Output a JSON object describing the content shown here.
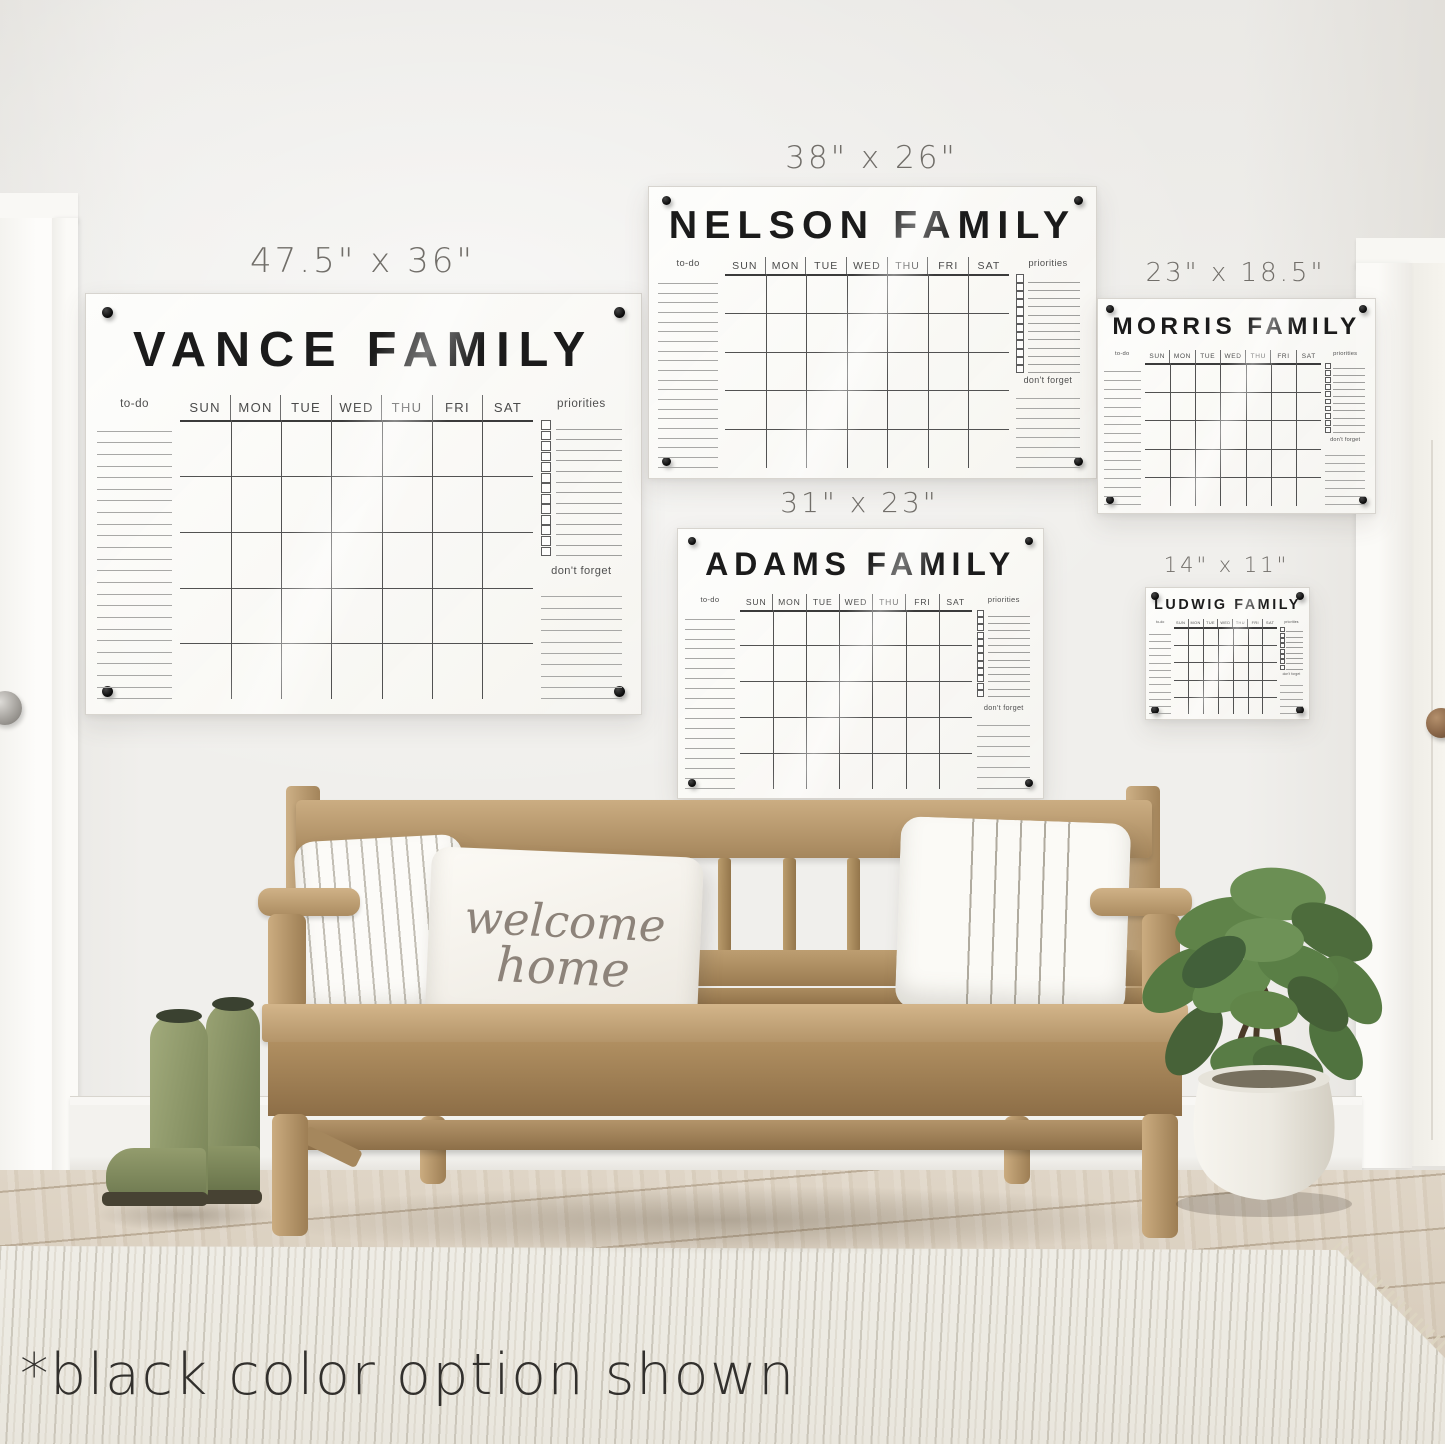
{
  "caption": "*black color option shown",
  "welcome_pillow": {
    "line1": "welcome",
    "line2": "home"
  },
  "shared": {
    "todo_label": "to-do",
    "priorities_label": "priorities",
    "dont_forget_label": "don't forget",
    "day_headers": [
      "SUN",
      "MON",
      "TUE",
      "WED",
      "THU",
      "FRI",
      "SAT"
    ]
  },
  "colors": {
    "marker_black": "#141414",
    "panel_white": "#fbfaf8",
    "wall": "#f0efec",
    "bench_wood": "#b7976c",
    "floor_wood": "#d8cdbd",
    "rug": "#edeae2",
    "boots_green": "#8a9366",
    "plant_green": "#5d7f47",
    "size_label_gray": "#716e69"
  },
  "calendars": [
    {
      "id": "vance",
      "title": "VANCE FAMILY",
      "size_label": "47.5\" x 36\"",
      "todo_lines": 24,
      "grid_rows": 5,
      "priorities_rows": 13,
      "dont_forget_lines": 10
    },
    {
      "id": "nelson",
      "title": "NELSON FAMILY",
      "size_label": "38\" x 26\"",
      "todo_lines": 20,
      "grid_rows": 5,
      "priorities_rows": 12,
      "dont_forget_lines": 8
    },
    {
      "id": "morris",
      "title": "MORRIS FAMILY",
      "size_label": "23\" x 18.5\"",
      "todo_lines": 16,
      "grid_rows": 5,
      "priorities_rows": 10,
      "dont_forget_lines": 7
    },
    {
      "id": "adams",
      "title": "ADAMS FAMILY",
      "size_label": "31\" x 23\"",
      "todo_lines": 18,
      "grid_rows": 5,
      "priorities_rows": 12,
      "dont_forget_lines": 7
    },
    {
      "id": "ludwig",
      "title": "LUDWIG FAMILY",
      "size_label": "14\" x 11\"",
      "todo_lines": 12,
      "grid_rows": 5,
      "priorities_rows": 8,
      "dont_forget_lines": 5
    }
  ]
}
